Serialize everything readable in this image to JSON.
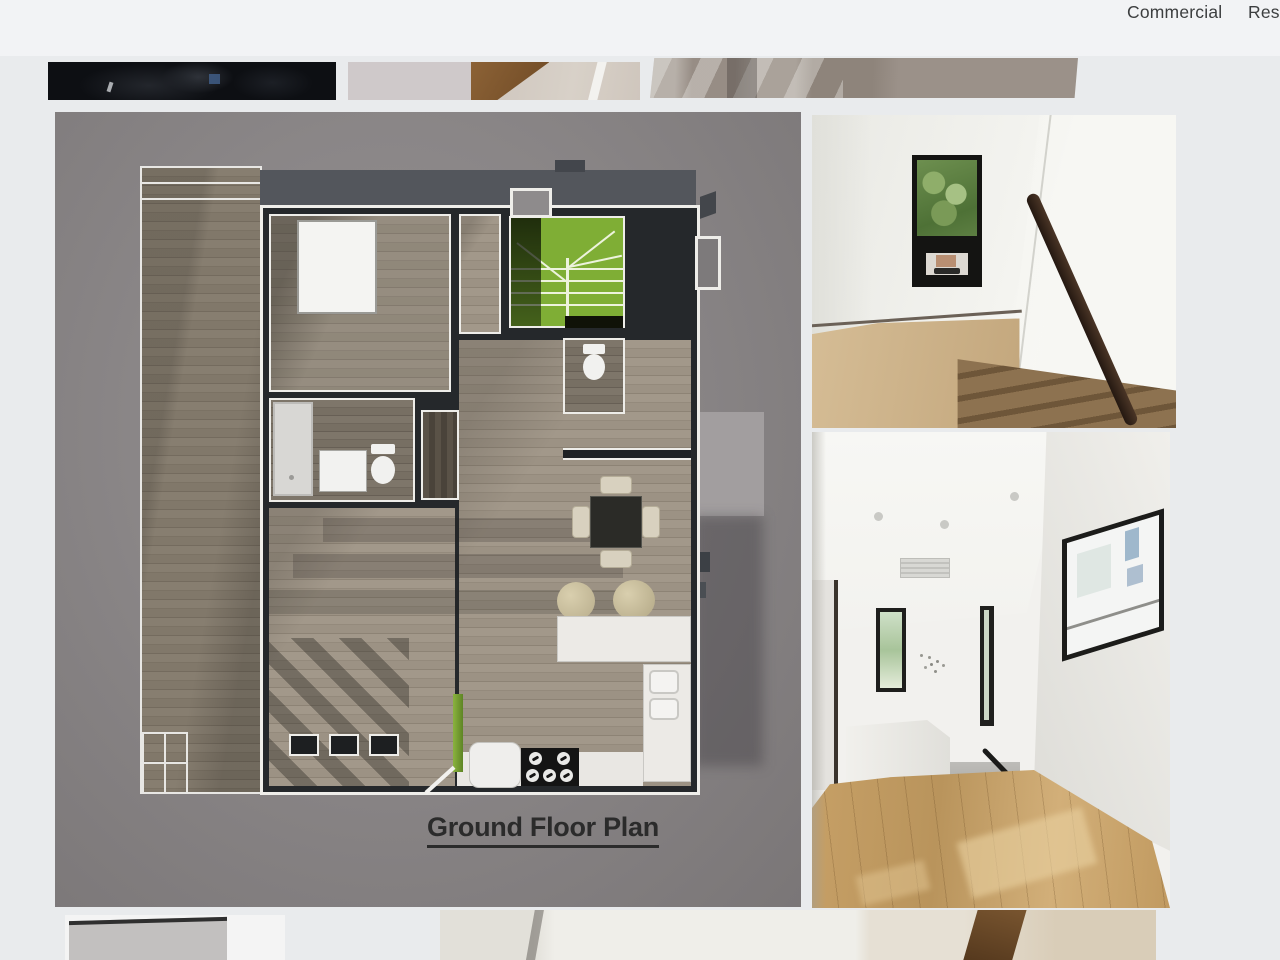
{
  "nav": {
    "items": [
      {
        "label": "Commercial"
      },
      {
        "label": "Res"
      }
    ]
  },
  "floor_plan": {
    "title": "Ground Floor Plan",
    "kind": "3d-rendered-ground-floor-plan"
  },
  "gallery": {
    "top_thumbnails": [
      {
        "name": "dark-interior-thumbnail"
      },
      {
        "name": "stair-corner-detail-thumbnail"
      },
      {
        "name": "staircase-wide-thumbnail"
      }
    ],
    "photos": [
      {
        "name": "stairwell-window-photo"
      },
      {
        "name": "upper-landing-hallway-photo"
      }
    ],
    "bottom_thumbnails": [
      {
        "name": "gray-door-thumbnail"
      },
      {
        "name": "stair-stringer-interior-thumbnail"
      }
    ]
  },
  "colors": {
    "page_background": "#e9ebed",
    "plan_panel_gray": "#8a8687",
    "wall_dark": "#25282b",
    "trim_white": "#eeede9",
    "stair_green": "#7fae35",
    "plan_wood": "#8e8679",
    "deck_wood": "#7d7468",
    "oak_floor": "#c49a62",
    "handrail_brown": "#3b2a1c",
    "nav_text": "#3c3e3f",
    "title_text": "#2b2b2b"
  }
}
